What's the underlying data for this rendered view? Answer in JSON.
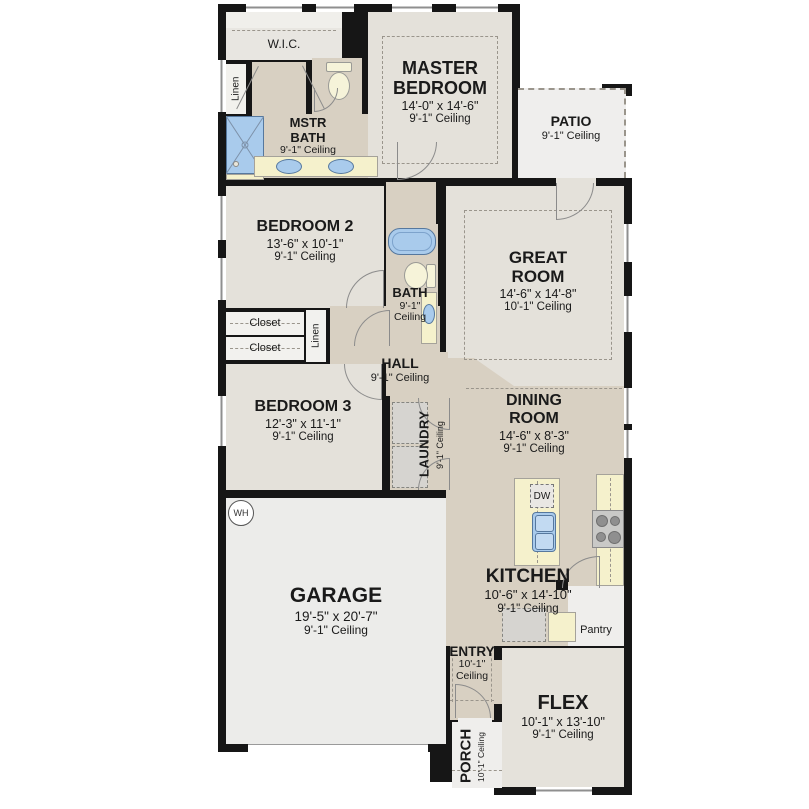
{
  "rooms": {
    "wic": {
      "name": "W.I.C."
    },
    "linen_top": {
      "name": "Linen"
    },
    "mstr_bath": {
      "name": "MSTR BATH",
      "ceiling": "9'-1\" Ceiling"
    },
    "master_bedroom": {
      "name": "MASTER BEDROOM",
      "dims": "14'-0\" x 14'-6\"",
      "ceiling": "9'-1\" Ceiling"
    },
    "patio": {
      "name": "PATIO",
      "ceiling": "9'-1\" Ceiling"
    },
    "bedroom2": {
      "name": "BEDROOM 2",
      "dims": "13'-6\" x 10'-1\"",
      "ceiling": "9'-1\" Ceiling"
    },
    "bath": {
      "name": "BATH",
      "ceiling": "9'-1\" Ceiling"
    },
    "great_room": {
      "name": "GREAT ROOM",
      "dims": "14'-6\" x 14'-8\"",
      "ceiling": "10'-1\" Ceiling"
    },
    "closet_a": {
      "name": "Closet"
    },
    "closet_b": {
      "name": "Closet"
    },
    "linen_hall": {
      "name": "Linen"
    },
    "hall": {
      "name": "HALL",
      "ceiling": "9'-1\" Ceiling"
    },
    "bedroom3": {
      "name": "BEDROOM 3",
      "dims": "12'-3\" x 11'-1\"",
      "ceiling": "9'-1\" Ceiling"
    },
    "laundry": {
      "name": "LAUNDRY",
      "ceiling": "9'-1\" Ceiling"
    },
    "dining_room": {
      "name": "DINING ROOM",
      "dims": "14'-6\" x 8'-3\"",
      "ceiling": "9'-1\" Ceiling"
    },
    "kitchen": {
      "name": "KITCHEN",
      "dims": "10'-6\" x 14'-10\"",
      "ceiling": "9'-1\" Ceiling"
    },
    "pantry": {
      "name": "Pantry"
    },
    "garage": {
      "name": "GARAGE",
      "dims": "19'-5\" x 20'-7\"",
      "ceiling": "9'-1\" Ceiling"
    },
    "entry": {
      "name": "ENTRY",
      "ceiling": "10'-1\" Ceiling"
    },
    "porch": {
      "name": "PORCH",
      "ceiling": "10'-1\" Ceiling"
    },
    "flex": {
      "name": "FLEX",
      "dims": "10'-1\" x 13'-10\"",
      "ceiling": "9'-1\" Ceiling"
    }
  },
  "fixtures": {
    "water_heater": "WH",
    "dishwasher": "DW"
  },
  "colors": {
    "wall": "#161616",
    "floor_light": "#e4e1da",
    "floor_tan": "#d8d0c2",
    "floor_gray": "#ebeae6",
    "counter_yellow": "#f5f1cc",
    "fixture_blue": "#a9cbec"
  }
}
